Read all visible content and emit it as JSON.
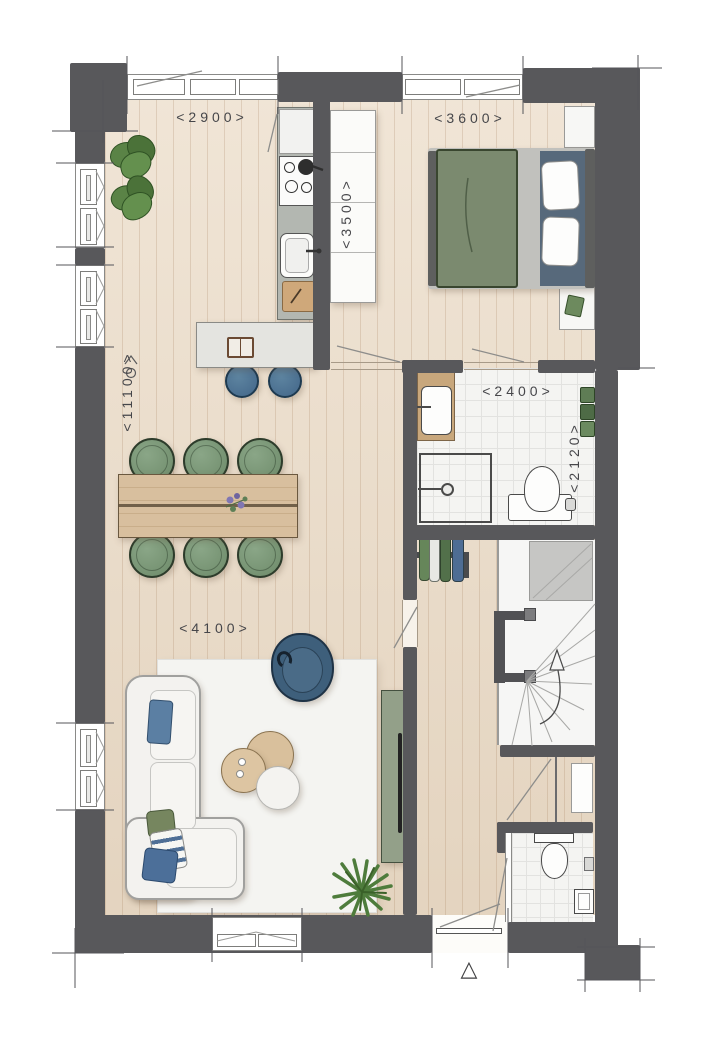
{
  "title": "Floor plan",
  "dimensions": {
    "kitchen_width": "<2900>",
    "bedroom_width": "<3600>",
    "kitchen_depth": "<3500>",
    "total_depth": "<11100>",
    "bathroom_width": "<2400>",
    "bathroom_depth": "<2120>",
    "living_width": "<4100>"
  },
  "markers": {
    "entrance": "△"
  },
  "colors": {
    "wall": "#58585b",
    "wood_floor": "#ebdcc8",
    "tile_floor": "#f4f4f2",
    "kitchen_counter": "#b3b7b1",
    "island": "#e4e4e0",
    "table_wood": "#d8bf9e",
    "chair_green": "#7e9879",
    "stool_blue": "#4b7390",
    "sofa_white": "#f3f2ef",
    "armchair_blue": "#3e5f7b",
    "bed_green": "#7b8a6f",
    "tv_cabinet_green": "#93a089",
    "plant_green": "#55823f",
    "label_text": "#46464a"
  }
}
